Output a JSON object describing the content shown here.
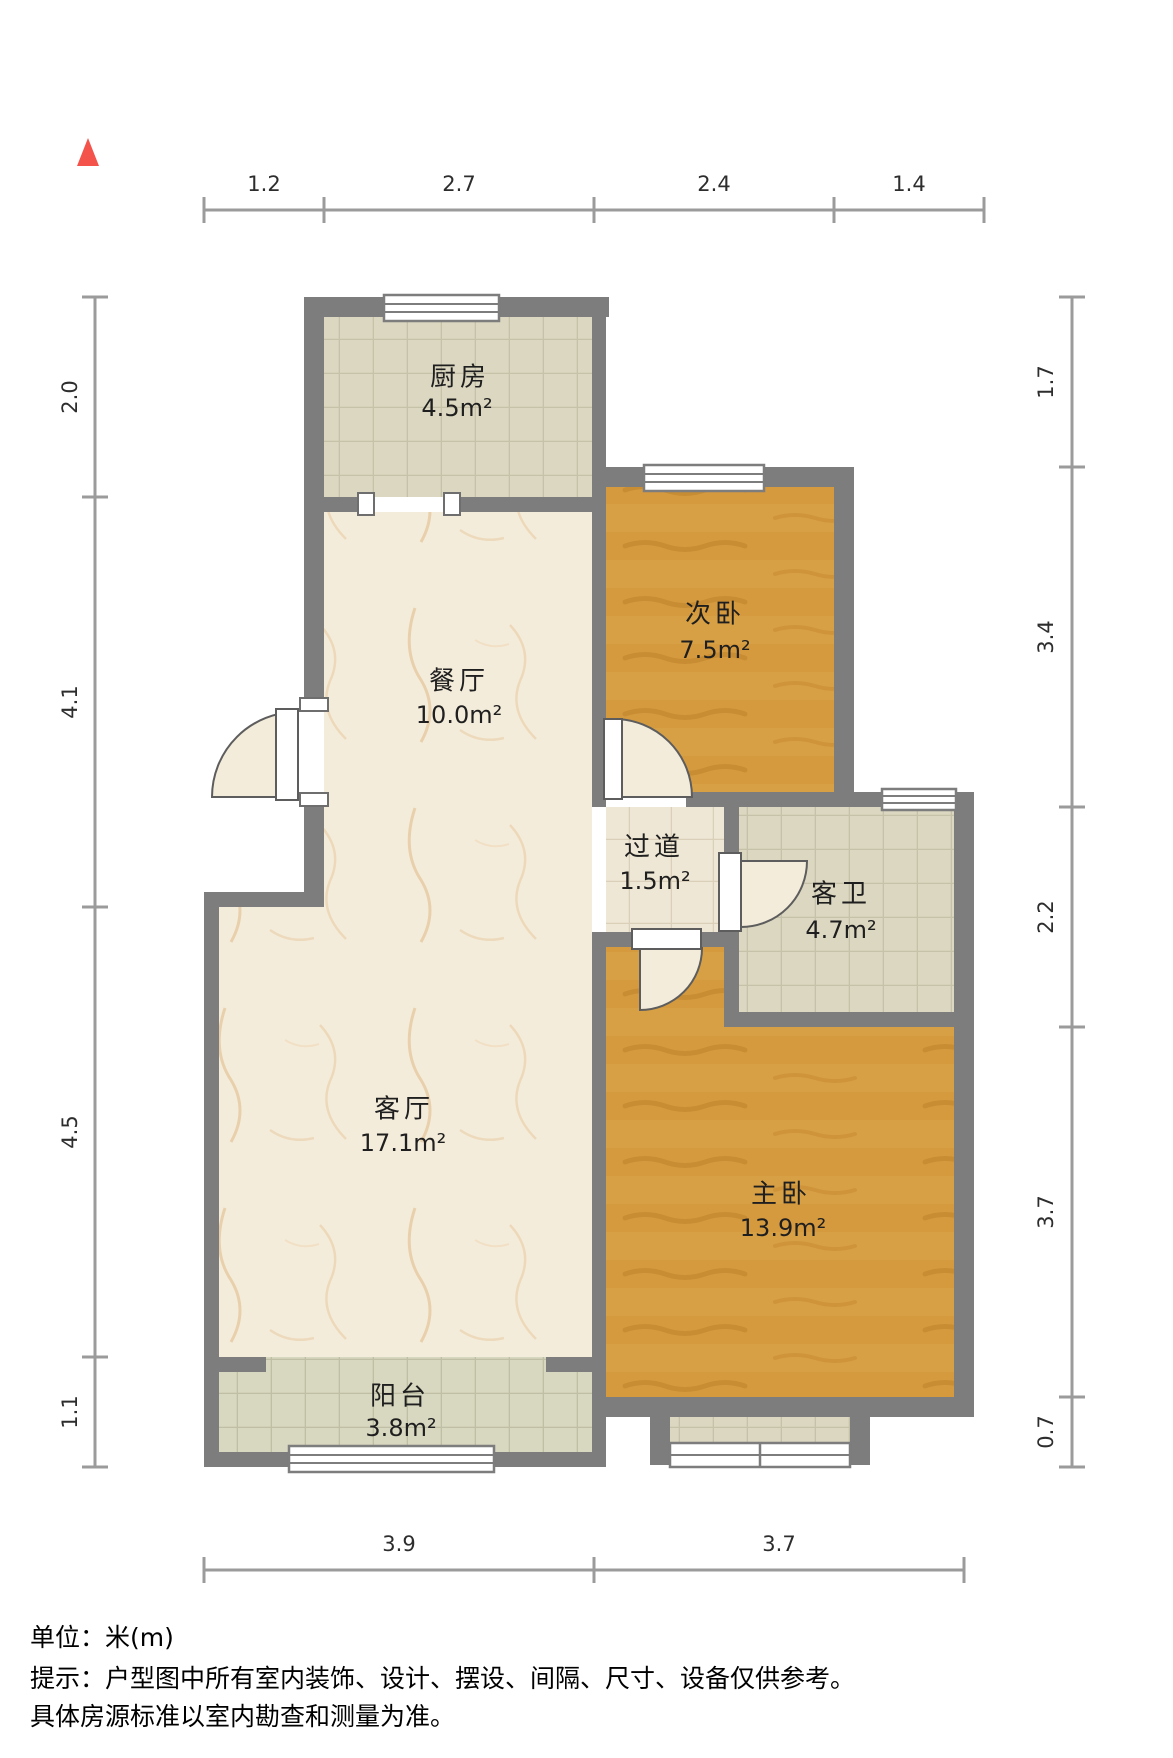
{
  "title": "户型图",
  "north_marker": {
    "icon": "north-triangle",
    "color": "#f3534b"
  },
  "rooms": [
    {
      "id": "kitchen",
      "name": "厨房",
      "area": "4.5m²"
    },
    {
      "id": "second-bedroom",
      "name": "次卧",
      "area": "7.5m²"
    },
    {
      "id": "dining-room",
      "name": "餐厅",
      "area": "10.0m²"
    },
    {
      "id": "hallway",
      "name": "过道",
      "area": "1.5m²"
    },
    {
      "id": "guest-bathroom",
      "name": "客卫",
      "area": "4.7m²"
    },
    {
      "id": "living-room",
      "name": "客厅",
      "area": "17.1m²"
    },
    {
      "id": "master-bedroom",
      "name": "主卧",
      "area": "13.9m²"
    },
    {
      "id": "balcony",
      "name": "阳台",
      "area": "3.8m²"
    }
  ],
  "dimensions": {
    "unit": "m",
    "top": [
      "1.2",
      "2.7",
      "2.4",
      "1.4"
    ],
    "left": [
      "2.0",
      "4.1",
      "4.5",
      "1.1"
    ],
    "right": [
      "1.7",
      "3.4",
      "2.2",
      "3.7",
      "0.7"
    ],
    "bottom": [
      "3.9",
      "3.7"
    ]
  },
  "colors": {
    "wall": "#7d7d7d",
    "wood_floor": "#d69a3e",
    "marble_floor": "#f4ecda",
    "tile_floor": "#dbd7c0",
    "dimension_line": "#9b9b9b",
    "north_arrow": "#f3534b"
  },
  "footer": {
    "unit_label": "单位：米(m)",
    "note_line1": "提示：户型图中所有室内装饰、设计、摆设、间隔、尺寸、设备仅供参考。",
    "note_line2": "具体房源标准以室内勘查和测量为准。"
  }
}
